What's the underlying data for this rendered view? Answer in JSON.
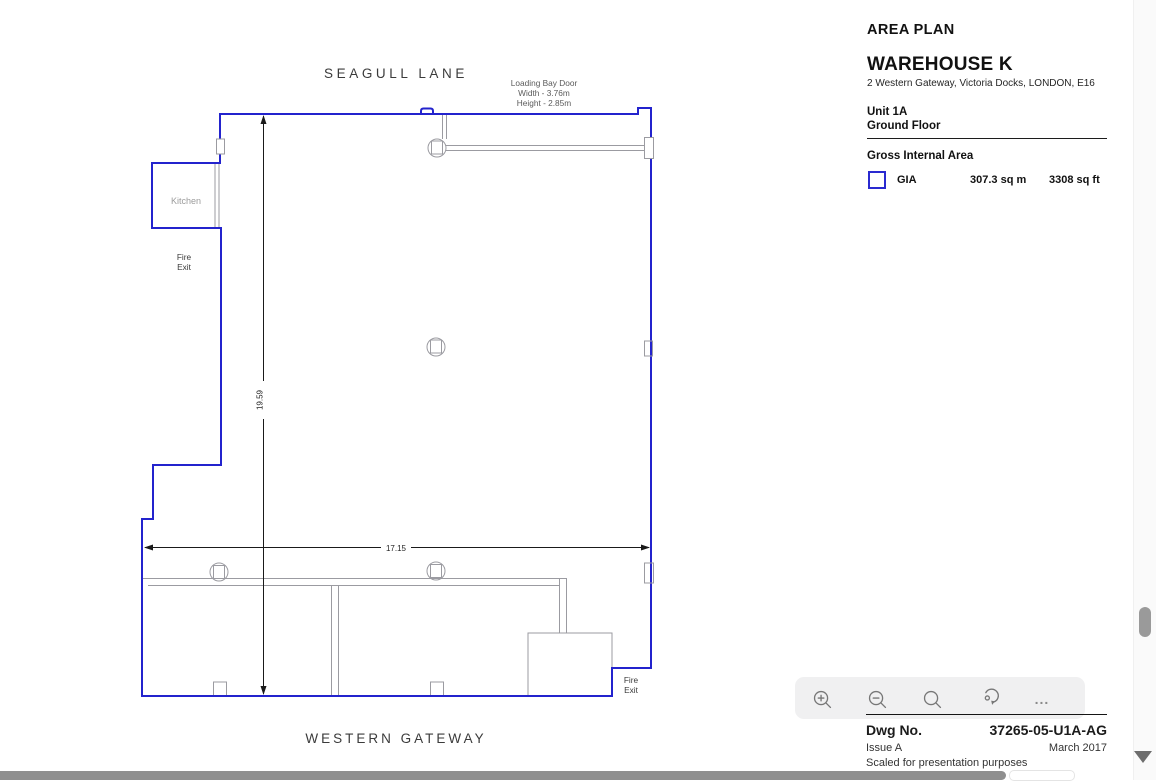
{
  "plan": {
    "street_top": "SEAGULL LANE",
    "street_bottom": "WESTERN GATEWAY",
    "loading_bay_door": {
      "line1": "Loading Bay Door",
      "line2": "Width - 3.76m",
      "line3": "Height - 2.85m"
    },
    "kitchen_label": "Kitchen",
    "fire_exit_left": {
      "line1": "Fire",
      "line2": "Exit"
    },
    "fire_exit_right": {
      "line1": "Fire",
      "line2": "Exit"
    },
    "dim_width_m": "17.15",
    "dim_height_m": "19.59",
    "colors": {
      "boundary_blue": "#2323cd",
      "wall_gray": "#9b9ba1",
      "dimension_black": "#1a1a1a"
    }
  },
  "info_panel": {
    "title": "AREA PLAN",
    "property_name": "WAREHOUSE K",
    "address": "2 Western Gateway, Victoria Docks, LONDON, E16",
    "unit": "Unit 1A",
    "floor": "Ground Floor",
    "gia_heading": "Gross Internal Area",
    "gia": {
      "label": "GIA",
      "sq_m": "307.3 sq m",
      "sq_ft": "3308 sq ft",
      "swatch_color": "#2a2ad0"
    }
  },
  "title_block": {
    "dwg_label": "Dwg No.",
    "dwg_number": "37265-05-U1A-AG",
    "issue": "Issue A",
    "date": "March 2017",
    "note": "Scaled for presentation purposes"
  },
  "viewer": {
    "toolbar_icons": [
      "zoom-in",
      "zoom-out",
      "search",
      "rotate",
      "more"
    ],
    "more_glyph": "..."
  }
}
